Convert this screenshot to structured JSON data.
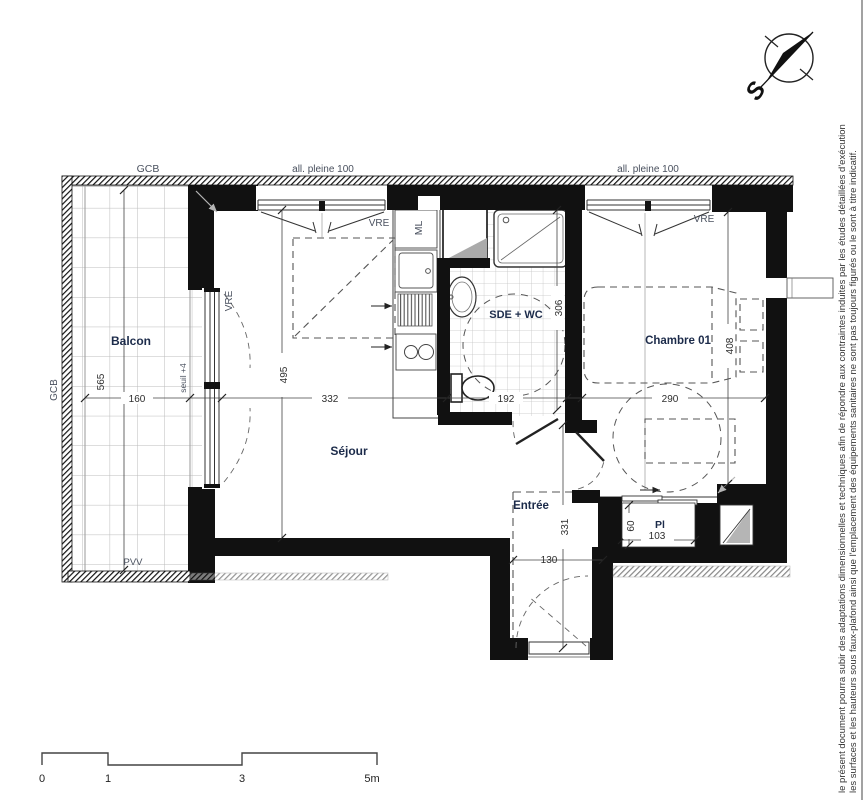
{
  "plan": {
    "rooms": {
      "balcon": "Balcon",
      "sejour": "Séjour",
      "sde_wc": "SDE + WC",
      "chambre": "Chambre 01",
      "entree": "Entrée",
      "placard": "Pl"
    },
    "labels": {
      "gcb_top": "GCB",
      "gcb_left": "GCB",
      "all_pleine_left": "all. pleine 100",
      "all_pleine_right": "all. pleine 100",
      "vre_sejour": "VRE",
      "vre_balcon": "VRE",
      "vre_chambre": "VRE",
      "ml": "ML",
      "pvv": "PVV",
      "seuil": "seuil +4"
    },
    "dimensions": {
      "balcon_h": "565",
      "balcon_w": "160",
      "sejour_w": "332",
      "sejour_h": "495",
      "sde_w": "192",
      "sde_h": "306",
      "chambre_w": "290",
      "chambre_h": "408",
      "entree_w": "130",
      "entree_h": "331",
      "pl_h": "60",
      "pl_w": "103"
    }
  },
  "compass": {
    "south": "S"
  },
  "scalebar": {
    "t0": "0",
    "t1": "1",
    "t3": "3",
    "t5": "5m"
  },
  "disclaimer": {
    "line1": "le présent document pourra subir des adaptations dimensionnelles et techniques afin de répondre aux contraintes induites par les études détaillées d'exécution",
    "line2": "les surfaces et les hauteurs sous faux-plafond ainsi que l'emplacement des équipements sanitaires ne sont pas toujours figurés ou le sont à titre indicatif."
  },
  "colors": {
    "wall": "#111111",
    "room_label": "#1c2b4a",
    "annotation": "#49505e",
    "dimension": "#2e2e2e",
    "tile_line": "#bbbbbb"
  }
}
